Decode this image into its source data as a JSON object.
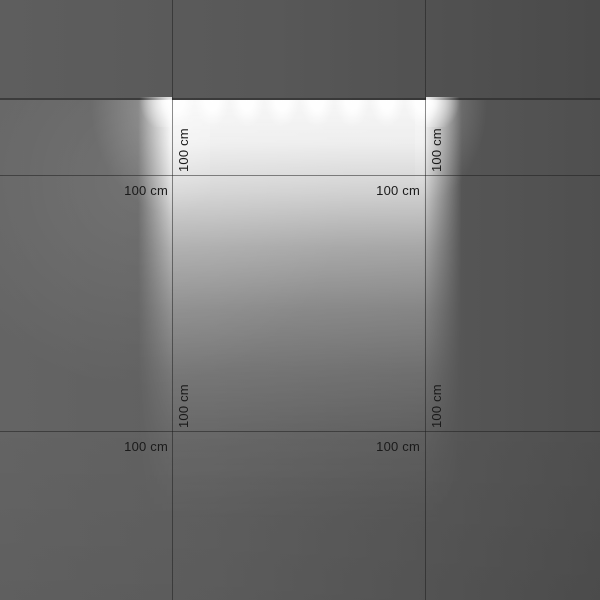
{
  "labels": [
    {
      "text": "100 cm",
      "orientation": "horizontal",
      "position": "row-1-left"
    },
    {
      "text": "100 cm",
      "orientation": "horizontal",
      "position": "row-1-right"
    },
    {
      "text": "100 cm",
      "orientation": "vertical",
      "position": "col-left-top"
    },
    {
      "text": "100 cm",
      "orientation": "vertical",
      "position": "col-right-top"
    },
    {
      "text": "100 cm",
      "orientation": "horizontal",
      "position": "row-2-left"
    },
    {
      "text": "100 cm",
      "orientation": "horizontal",
      "position": "row-2-right"
    },
    {
      "text": "100 cm",
      "orientation": "vertical",
      "position": "col-left-bottom"
    },
    {
      "text": "100 cm",
      "orientation": "vertical",
      "position": "col-right-bottom"
    }
  ],
  "grid": {
    "unit_label": "100 cm",
    "vertical_lines_x_px": [
      172,
      425
    ],
    "horizontal_lines_y_px": [
      175,
      431
    ]
  },
  "fixture": {
    "scallop_count": 8,
    "scallop_start_x_px": 177,
    "scallop_spacing_px": 35,
    "mounting_y_px": 100,
    "span_x_px": [
      152,
      452
    ]
  },
  "colors": {
    "wall_base": "#5a5a5a",
    "shadow_band": "#515151",
    "light_core": "#ffffff",
    "grid_line": "rgba(25,25,25,0.5)",
    "label_text": "#1a1a1a"
  }
}
